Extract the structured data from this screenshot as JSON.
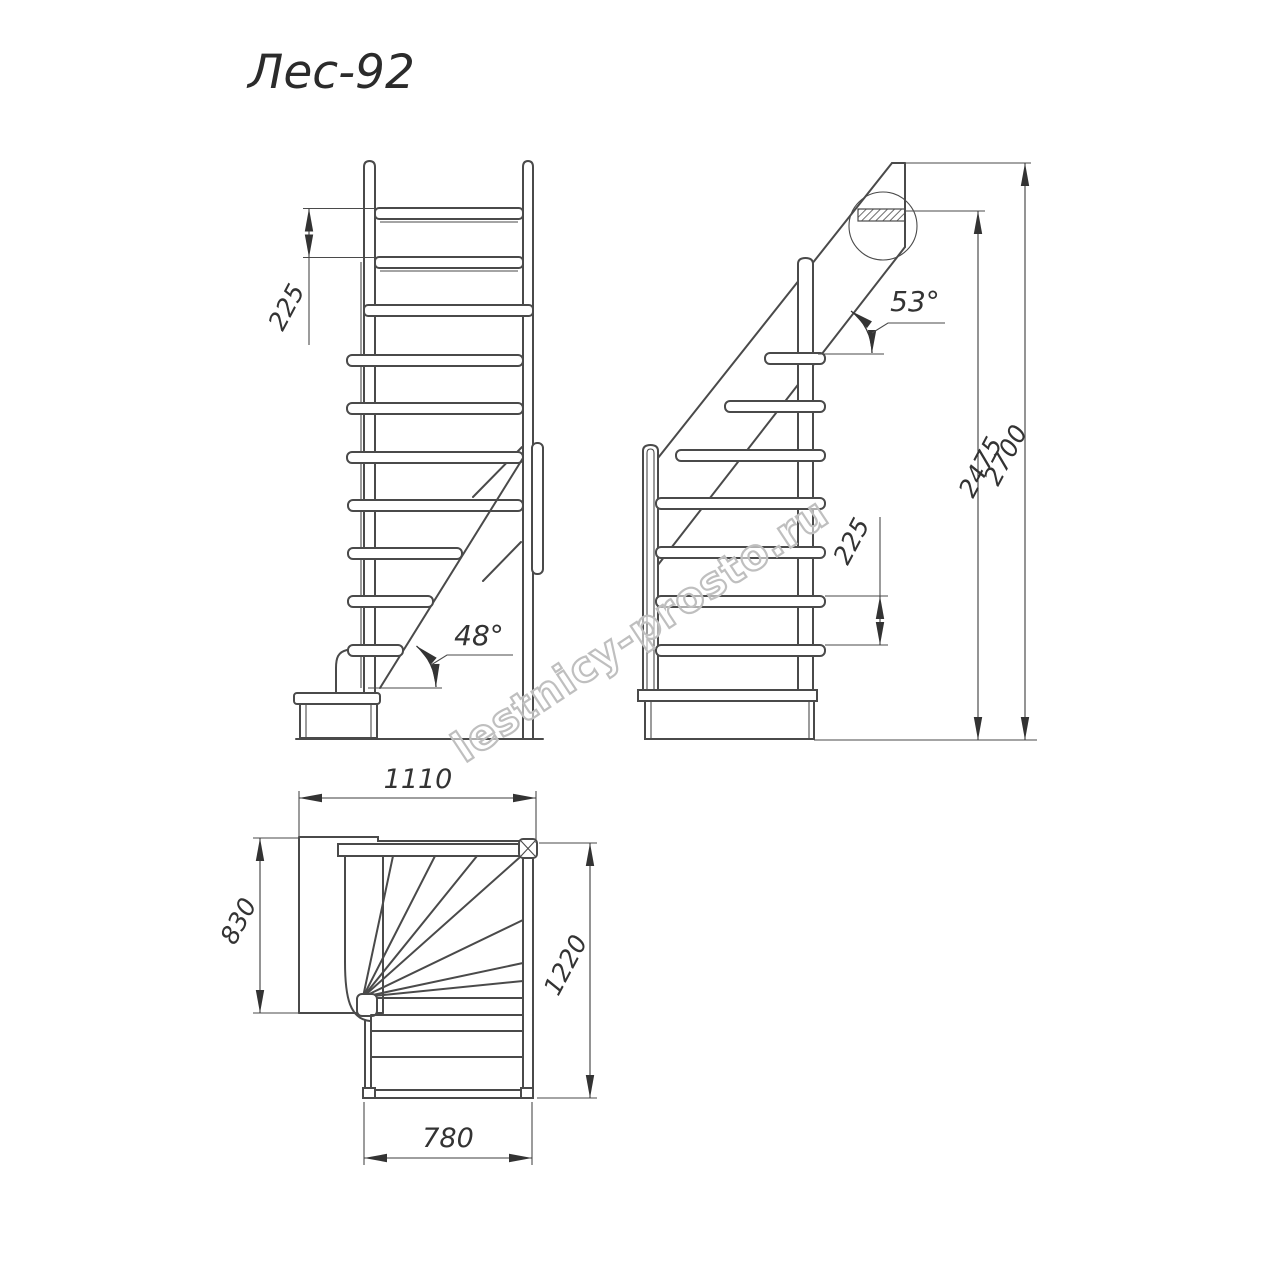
{
  "title": "Лес-92",
  "watermark": "lestnicy-prosto.ru",
  "colors": {
    "line": "#4a4a4a",
    "text": "#333333",
    "watermark_outline": "#bfbfbf",
    "background": "#ffffff"
  },
  "front_view": {
    "riser_height": "225",
    "stringer_angle": "48°"
  },
  "side_view": {
    "riser_height": "225",
    "stringer_angle": "53°",
    "height_to_top_tread": "2475",
    "total_height": "2700"
  },
  "plan_view": {
    "overall_width": "1110",
    "landing_depth": "830",
    "flight_length": "1220",
    "flight_width": "780"
  }
}
